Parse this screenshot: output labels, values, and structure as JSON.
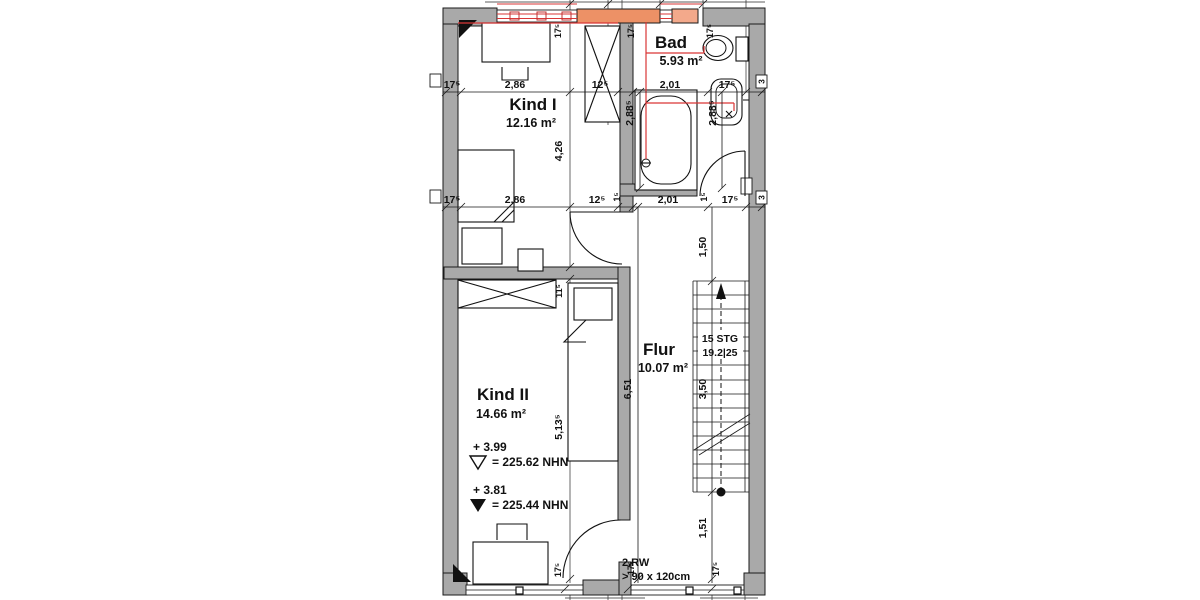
{
  "plan": {
    "rooms": {
      "kind1": {
        "name": "Kind I",
        "area": "12.16 m²"
      },
      "bad": {
        "name": "Bad",
        "area": "5.93 m²"
      },
      "kind2": {
        "name": "Kind II",
        "area": "14.66 m²"
      },
      "flur": {
        "name": "Flur",
        "area": "10.07 m²"
      }
    },
    "stairs": {
      "steps": "15 STG",
      "ratio": "19.2|25"
    },
    "elevations": {
      "upper": {
        "value": "+ 3.99",
        "datum": "= 225.62 NHN"
      },
      "lower": {
        "value": "+ 3.81",
        "datum": "= 225.44 NHN"
      }
    },
    "escape_window": {
      "label": "2.RW",
      "size": "> 90 x 120cm"
    },
    "axes": {
      "right_top": "3",
      "right_bottom": "3"
    },
    "dims": {
      "row1": [
        "17⁵",
        "2,86",
        "12⁵",
        "2,01",
        "17⁵"
      ],
      "row2": [
        "17⁵",
        "2,86",
        "12⁵",
        "1⁵",
        "2,01",
        "1⁵",
        "17⁵"
      ],
      "wall_top": [
        "17⁵",
        "17⁵",
        "17⁵"
      ],
      "wall_bottom": [
        "17⁵",
        "17⁵",
        "17⁵"
      ],
      "v_kind": [
        "4,26",
        "11⁵",
        "5,13⁵"
      ],
      "v_bad": [
        "2,88⁵",
        "2,88⁵"
      ],
      "v_flur": [
        "6,51"
      ],
      "v_right": [
        "1,50",
        "3,50",
        "1,51"
      ]
    },
    "colors": {
      "highlight_wall": "#ed9166",
      "highlight_wall_light": "#f3a98b",
      "utility_red": "#d93636"
    }
  }
}
